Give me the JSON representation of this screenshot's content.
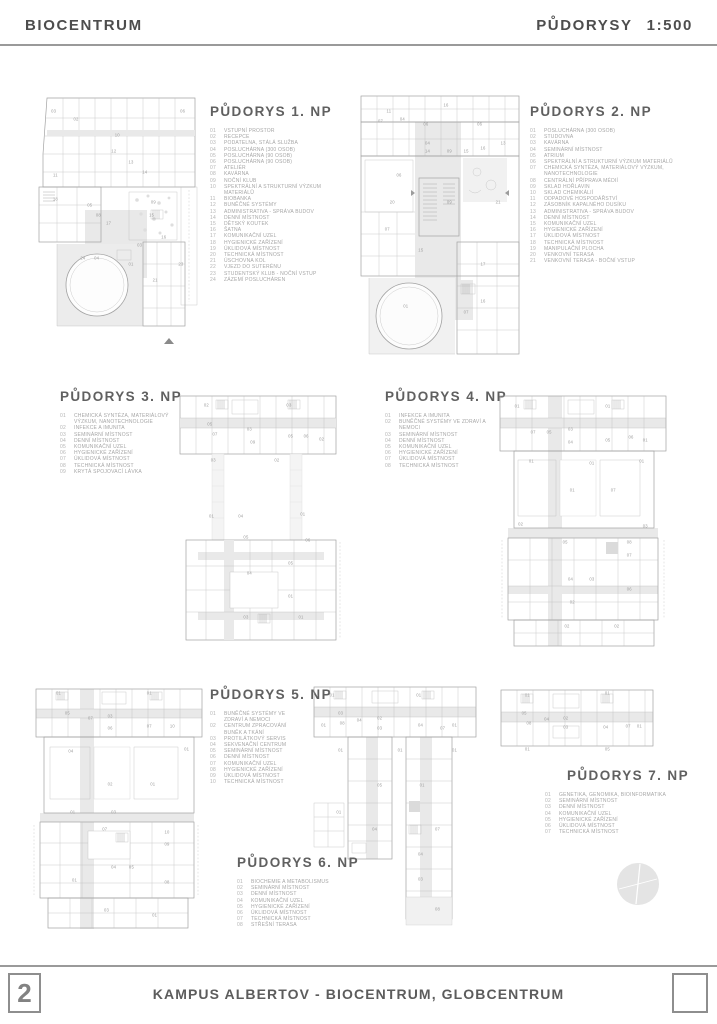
{
  "header": {
    "project": "BIOCENTRUM",
    "sheet": "PŮDORYSY",
    "scale": "1:500"
  },
  "footer": {
    "page_number": "2",
    "title": "KAMPUS ALBERTOV - BIOCENTRUM, GLOBCENTRUM"
  },
  "colors": {
    "line": "#a2a2a2",
    "shade": "#e9e9e9",
    "text": "#a6a6a6",
    "title": "#606060"
  },
  "plans": [
    {
      "title": "PŮDORYS 1. NP",
      "items": [
        [
          "01",
          "VSTUPNÍ PROSTOR"
        ],
        [
          "02",
          "RECEPCE"
        ],
        [
          "03",
          "PODATELNA, STÁLÁ SLUŽBA"
        ],
        [
          "04",
          "POSLUCHÁRNA (300 OSOB)"
        ],
        [
          "05",
          "POSLUCHÁRNA (90 OSOB)"
        ],
        [
          "06",
          "POSLUCHÁRNA (90 OSOB)"
        ],
        [
          "07",
          "ATELIÉR"
        ],
        [
          "08",
          "KAVÁRNA"
        ],
        [
          "09",
          "NOČNÍ KLUB"
        ],
        [
          "10",
          "SPEKTRÁLNÍ A STRUKTURNÍ VÝZKUM MATERIÁLŮ"
        ],
        [
          "11",
          "BIOBANKA"
        ],
        [
          "12",
          "BUNĚČNÉ SYSTÉMY"
        ],
        [
          "13",
          "ADMINISTRATIVA - SPRÁVA BUDOV"
        ],
        [
          "14",
          "DENNÍ MÍSTNOST"
        ],
        [
          "15",
          "DĚTSKÝ KOUTEK"
        ],
        [
          "16",
          "ŠATNA"
        ],
        [
          "17",
          "KOMUNIKAČNÍ UZEL"
        ],
        [
          "18",
          "HYGIENICKÉ ZAŘÍZENÍ"
        ],
        [
          "19",
          "ÚKLIDOVÁ MÍSTNOST"
        ],
        [
          "20",
          "TECHNICKÁ MÍSTNOST"
        ],
        [
          "21",
          "ÚSCHOVNA KOL"
        ],
        [
          "22",
          "VJEZD DO SUTERÉNU"
        ],
        [
          "23",
          "STUDENTSKÝ KLUB - NOČNÍ VSTUP"
        ],
        [
          "24",
          "ZÁZEMÍ POSLUCHÁREN"
        ]
      ],
      "room_labels": [
        [
          12,
          7,
          "03"
        ],
        [
          87,
          7,
          "06"
        ],
        [
          25,
          10,
          "02"
        ],
        [
          49,
          16,
          "10"
        ],
        [
          47,
          22,
          "12"
        ],
        [
          57,
          26,
          "13"
        ],
        [
          65,
          30,
          "14"
        ],
        [
          13,
          31,
          "11"
        ],
        [
          13,
          40,
          "18"
        ],
        [
          33,
          42,
          "05"
        ],
        [
          70,
          41,
          "09"
        ],
        [
          38,
          46,
          "08"
        ],
        [
          44,
          49,
          "17"
        ],
        [
          69,
          46,
          "15"
        ],
        [
          76,
          54,
          "16"
        ],
        [
          62,
          57,
          "03"
        ],
        [
          29,
          62,
          "24"
        ],
        [
          37,
          62,
          "04"
        ],
        [
          57,
          64,
          "01"
        ],
        [
          86,
          64,
          "23"
        ],
        [
          71,
          70,
          "21"
        ]
      ]
    },
    {
      "title": "PŮDORYS 2. NP",
      "items": [
        [
          "01",
          "POSLUCHÁRNA (300 OSOB)"
        ],
        [
          "02",
          "STUDOVNA"
        ],
        [
          "03",
          "KAVÁRNA"
        ],
        [
          "04",
          "SEMINÁRNÍ MÍSTNOST"
        ],
        [
          "05",
          "ATRIUM"
        ],
        [
          "06",
          "SPEKTRÁLNÍ A STRUKTURNÍ VÝZKUM MATERIÁLŮ"
        ],
        [
          "07",
          "CHEMICKÁ SYNTÉZA, MATERIÁLOVÝ VÝZKUM, NANOTECHNOLOGIE"
        ],
        [
          "08",
          "CENTRÁLNÍ PŘÍPRAVA MÉDIÍ"
        ],
        [
          "09",
          "SKLAD HOŘLAVIN"
        ],
        [
          "10",
          "SKLAD CHEMIKÁLIÍ"
        ],
        [
          "11",
          "ODPADOVÉ HOSPODÁŘSTVÍ"
        ],
        [
          "12",
          "ZÁSOBNÍK KAPALNÉHO DUSÍKU"
        ],
        [
          "13",
          "ADMINISTRATIVA - SPRÁVA BUDOV"
        ],
        [
          "14",
          "DENNÍ MÍSTNOST"
        ],
        [
          "15",
          "KOMUNIKAČNÍ UZEL"
        ],
        [
          "16",
          "HYGIENICKÉ ZAŘÍZENÍ"
        ],
        [
          "17",
          "ÚKLIDOVÁ MÍSTNOST"
        ],
        [
          "18",
          "TECHNICKÁ MÍSTNOST"
        ],
        [
          "19",
          "MANIPULAČNÍ PLOCHA"
        ],
        [
          "20",
          "VENKOVNÍ TERASA"
        ],
        [
          "21",
          "VENKOVNÍ TERASA - BOČNÍ VSTUP"
        ]
      ],
      "room_labels": [
        [
          19,
          7,
          "11"
        ],
        [
          53,
          5,
          "16"
        ],
        [
          14,
          11,
          "07"
        ],
        [
          27,
          10,
          "04"
        ],
        [
          41,
          12,
          "06"
        ],
        [
          73,
          12,
          "06"
        ],
        [
          42,
          19,
          "04"
        ],
        [
          42,
          22,
          "14"
        ],
        [
          55,
          22,
          "09"
        ],
        [
          65,
          22,
          "15"
        ],
        [
          75,
          21,
          "16"
        ],
        [
          87,
          19,
          "13"
        ],
        [
          25,
          31,
          "06"
        ],
        [
          21,
          41,
          "20"
        ],
        [
          55,
          41,
          "09"
        ],
        [
          84,
          41,
          "21"
        ],
        [
          18,
          51,
          "07"
        ],
        [
          38,
          59,
          "15"
        ],
        [
          75,
          64,
          "17"
        ],
        [
          29,
          80,
          "01"
        ],
        [
          75,
          78,
          "16"
        ],
        [
          65,
          82,
          "07"
        ]
      ]
    },
    {
      "title": "PŮDORYS 3. NP",
      "items": [
        [
          "01",
          "CHEMICKÁ SYNTÉZA, MATERIÁLOVÝ VÝZKUM, NANOTECHNOLOGIE"
        ],
        [
          "02",
          "INFEKCE A IMUNITA"
        ],
        [
          "03",
          "SEMINÁRNÍ MÍSTNOST"
        ],
        [
          "04",
          "DENNÍ MÍSTNOST"
        ],
        [
          "05",
          "KOMUNIKAČNÍ UZEL"
        ],
        [
          "06",
          "HYGIENICKÉ ZAŘÍZENÍ"
        ],
        [
          "07",
          "ÚKLIDOVÁ MÍSTNOST"
        ],
        [
          "08",
          "TECHNICKÁ MÍSTNOST"
        ],
        [
          "09",
          "KRYTÁ SPOJOVACÍ LÁVKA"
        ]
      ],
      "room_labels": [
        [
          20,
          6,
          "02"
        ],
        [
          68,
          6,
          "03"
        ],
        [
          22,
          13,
          "05"
        ],
        [
          25,
          17,
          "07"
        ],
        [
          45,
          15,
          "03"
        ],
        [
          47,
          20,
          "09"
        ],
        [
          69,
          18,
          "05"
        ],
        [
          78,
          18,
          "06"
        ],
        [
          87,
          19,
          "02"
        ],
        [
          24,
          27,
          "03"
        ],
        [
          61,
          27,
          "02"
        ],
        [
          23,
          49,
          "01"
        ],
        [
          40,
          49,
          "04"
        ],
        [
          76,
          48,
          "01"
        ],
        [
          43,
          57,
          "05"
        ],
        [
          79,
          58,
          "06"
        ],
        [
          69,
          67,
          "05"
        ],
        [
          45,
          71,
          "04"
        ],
        [
          69,
          80,
          "01"
        ],
        [
          43,
          88,
          "03"
        ],
        [
          75,
          88,
          "01"
        ]
      ]
    },
    {
      "title": "PŮDORYS 4. NP",
      "items": [
        [
          "01",
          "INFEKCE A IMUNITA"
        ],
        [
          "02",
          "BUNĚČNÉ SYSTÉMY VE ZDRAVÍ A NEMOCI"
        ],
        [
          "03",
          "SEMINÁRNÍ MÍSTNOST"
        ],
        [
          "04",
          "DENNÍ MÍSTNOST"
        ],
        [
          "05",
          "KOMUNIKAČNÍ UZEL"
        ],
        [
          "06",
          "HYGIENICKÉ ZAŘÍZENÍ"
        ],
        [
          "07",
          "ÚKLIDOVÁ MÍSTNOST"
        ],
        [
          "08",
          "TECHNICKÁ MÍSTNOST"
        ]
      ],
      "room_labels": [
        [
          13,
          6,
          "01"
        ],
        [
          64,
          6,
          "01"
        ],
        [
          22,
          16,
          "07"
        ],
        [
          31,
          16,
          "05"
        ],
        [
          43,
          15,
          "03"
        ],
        [
          43,
          20,
          "04"
        ],
        [
          64,
          19,
          "05"
        ],
        [
          77,
          18,
          "06"
        ],
        [
          85,
          19,
          "01"
        ],
        [
          21,
          27,
          "01"
        ],
        [
          55,
          28,
          "01"
        ],
        [
          83,
          27,
          "01"
        ],
        [
          44,
          38,
          "01"
        ],
        [
          67,
          38,
          "07"
        ],
        [
          15,
          51,
          "02"
        ],
        [
          85,
          52,
          "03"
        ],
        [
          40,
          58,
          "05"
        ],
        [
          76,
          58,
          "08"
        ],
        [
          76,
          63,
          "07"
        ],
        [
          43,
          72,
          "04"
        ],
        [
          55,
          72,
          "03"
        ],
        [
          76,
          76,
          "06"
        ],
        [
          44,
          81,
          "02"
        ],
        [
          41,
          90,
          "02"
        ],
        [
          69,
          90,
          "02"
        ]
      ]
    },
    {
      "title": "PŮDORYS 5. NP",
      "items": [
        [
          "01",
          "BUNĚČNÉ SYSTÉMY VE ZDRAVÍ A NEMOCI"
        ],
        [
          "02",
          "CENTRUM ZPRACOVÁNÍ BUNĚK A TKÁNÍ"
        ],
        [
          "03",
          "PROTILÁTKOVÝ SERVIS"
        ],
        [
          "04",
          "SEKVENAČNÍ CENTRUM"
        ],
        [
          "05",
          "SEMINÁRNÍ MÍSTNOST"
        ],
        [
          "06",
          "DENNÍ MÍSTNOST"
        ],
        [
          "07",
          "KOMUNIKAČNÍ UZEL"
        ],
        [
          "08",
          "HYGIENICKÉ ZAŘÍZENÍ"
        ],
        [
          "09",
          "ÚKLIDOVÁ MÍSTNOST"
        ],
        [
          "10",
          "TECHNICKÁ MÍSTNOST"
        ]
      ],
      "room_labels": [
        [
          16,
          4,
          "01"
        ],
        [
          67,
          4,
          "01"
        ],
        [
          21,
          12,
          "05"
        ],
        [
          34,
          14,
          "07"
        ],
        [
          45,
          13,
          "03"
        ],
        [
          45,
          18,
          "06"
        ],
        [
          67,
          17,
          "07"
        ],
        [
          80,
          17,
          "10"
        ],
        [
          23,
          27,
          "04"
        ],
        [
          88,
          26,
          "01"
        ],
        [
          45,
          40,
          "02"
        ],
        [
          69,
          40,
          "01"
        ],
        [
          24,
          51,
          "01"
        ],
        [
          47,
          51,
          "03"
        ],
        [
          42,
          58,
          "07"
        ],
        [
          77,
          59,
          "10"
        ],
        [
          77,
          64,
          "09"
        ],
        [
          47,
          73,
          "04"
        ],
        [
          57,
          73,
          "05"
        ],
        [
          25,
          78,
          "01"
        ],
        [
          77,
          79,
          "08"
        ],
        [
          43,
          90,
          "03"
        ],
        [
          70,
          92,
          "01"
        ]
      ]
    },
    {
      "title": "PŮDORYS 6. NP",
      "items": [
        [
          "01",
          "BIOCHEMIE A METABOLISMUS"
        ],
        [
          "02",
          "SEMINÁRNÍ MÍSTNOST"
        ],
        [
          "03",
          "DENNÍ MÍSTNOST"
        ],
        [
          "04",
          "KOMUNIKAČNÍ UZEL"
        ],
        [
          "05",
          "HYGIENICKÉ ZAŘÍZENÍ"
        ],
        [
          "06",
          "ÚKLIDOVÁ MÍSTNOST"
        ],
        [
          "07",
          "TECHNICKÁ MÍSTNOST"
        ],
        [
          "08",
          "STŘEŠNÍ TERASA"
        ]
      ],
      "room_labels": [
        [
          13,
          5,
          "01"
        ],
        [
          64,
          5,
          "01"
        ],
        [
          18,
          12,
          "03"
        ],
        [
          19,
          16,
          "08"
        ],
        [
          29,
          15,
          "04"
        ],
        [
          41,
          14,
          "02"
        ],
        [
          41,
          18,
          "03"
        ],
        [
          65,
          17,
          "04"
        ],
        [
          78,
          18,
          "07"
        ],
        [
          85,
          17,
          "01"
        ],
        [
          8,
          17,
          "01"
        ],
        [
          18,
          27,
          "01"
        ],
        [
          53,
          27,
          "01"
        ],
        [
          85,
          27,
          "01"
        ],
        [
          41,
          41,
          "05"
        ],
        [
          66,
          41,
          "01"
        ],
        [
          17,
          52,
          "01"
        ],
        [
          38,
          59,
          "04"
        ],
        [
          75,
          59,
          "07"
        ],
        [
          65,
          69,
          "04"
        ],
        [
          65,
          79,
          "03"
        ],
        [
          75,
          91,
          "08"
        ]
      ]
    },
    {
      "title": "PŮDORYS 7. NP",
      "items": [
        [
          "01",
          "GENETIKA, GENOMIKA, BIOINFORMATIKA"
        ],
        [
          "02",
          "SEMINÁRNÍ MÍSTNOST"
        ],
        [
          "03",
          "DENNÍ MÍSTNOST"
        ],
        [
          "04",
          "KOMUNIKAČNÍ UZEL"
        ],
        [
          "05",
          "HYGIENICKÉ ZAŘÍZENÍ"
        ],
        [
          "06",
          "ÚKLIDOVÁ MÍSTNOST"
        ],
        [
          "07",
          "TECHNICKÁ MÍSTNOST"
        ]
      ],
      "room_labels": [
        [
          19,
          11,
          "01"
        ],
        [
          69,
          9,
          "01"
        ],
        [
          17,
          34,
          "05"
        ],
        [
          20,
          46,
          "08"
        ],
        [
          31,
          41,
          "04"
        ],
        [
          43,
          40,
          "02"
        ],
        [
          43,
          51,
          "03"
        ],
        [
          68,
          51,
          "04"
        ],
        [
          82,
          50,
          "07"
        ],
        [
          89,
          50,
          "01"
        ],
        [
          19,
          79,
          "01"
        ],
        [
          69,
          79,
          "05"
        ]
      ]
    }
  ]
}
